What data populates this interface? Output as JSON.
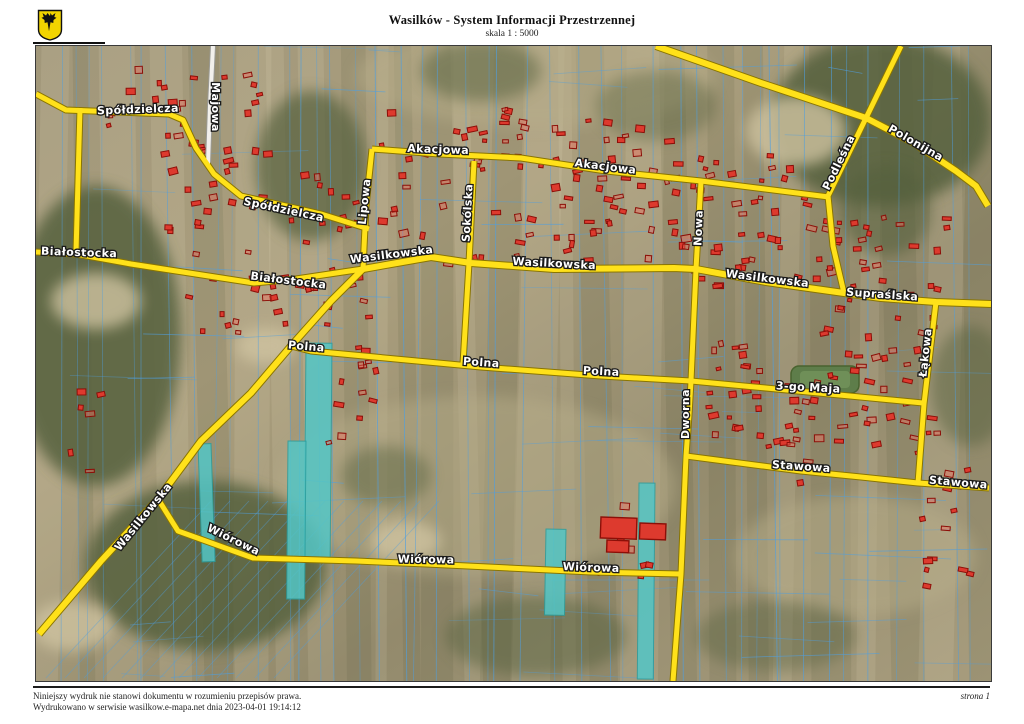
{
  "header": {
    "title": "Wasilków - System Informacji Przestrzennej",
    "scale_label": "skala 1 : 5000",
    "logo": "wasilkow-coat-of-arms-moose"
  },
  "footer": {
    "disclaimer": "Niniejszy wydruk nie stanowi dokumentu w rozumieniu przepisów prawa.",
    "printed_info": "Wydrukowano w serwisie wasilkow.e-mapa.net dnia 2023-04-01 19:14:12",
    "page_label": "strona 1"
  },
  "map": {
    "width": 955,
    "height": 635,
    "colors": {
      "road_fill": "#ffe11a",
      "road_casing": "#8a7500",
      "white_road": "#f2f0ec",
      "white_road_casing": "#9a9a94",
      "parcel_line": "#4f9fe0",
      "building_fill": "#dd3a2e",
      "building_fill_light": "rgba(240,110,95,0.45)",
      "building_stroke": "#8c0f08",
      "highlight_parcel": "#53c6c6",
      "highlight_stroke": "#2a9d9d",
      "label_fill": "#ffffff",
      "label_stroke": "#1a1a1a",
      "forest": "#55613c",
      "sand": "#cfc3a0",
      "field_light": "#b7ad89",
      "sports_green": "#5e7d4a"
    },
    "roads": [
      {
        "name": "majowa",
        "kind": "white",
        "w": 4,
        "points": [
          [
            177,
            0
          ],
          [
            174,
            60
          ],
          [
            172,
            118
          ]
        ]
      },
      {
        "name": "spoldzielcza",
        "kind": "yellow",
        "w": 5,
        "points": [
          [
            0,
            48
          ],
          [
            30,
            64
          ],
          [
            133,
            68
          ],
          [
            147,
            74
          ],
          [
            160,
            102
          ],
          [
            178,
            128
          ],
          [
            205,
            150
          ],
          [
            250,
            160
          ],
          [
            285,
            168
          ],
          [
            333,
            183
          ]
        ]
      },
      {
        "name": "bialostocka-north-leg",
        "kind": "yellow",
        "w": 5,
        "points": [
          [
            44,
            62
          ],
          [
            40,
            207
          ]
        ]
      },
      {
        "name": "bialostocka",
        "kind": "yellow",
        "w": 5,
        "points": [
          [
            0,
            206
          ],
          [
            40,
            208
          ],
          [
            95,
            218
          ],
          [
            218,
            237
          ],
          [
            260,
            233
          ],
          [
            327,
            223
          ]
        ]
      },
      {
        "name": "lipowa",
        "kind": "yellow",
        "w": 5,
        "points": [
          [
            336,
            103
          ],
          [
            330,
            160
          ],
          [
            327,
            223
          ]
        ]
      },
      {
        "name": "akacjowa",
        "kind": "yellow",
        "w": 5,
        "points": [
          [
            336,
            103
          ],
          [
            403,
            108
          ],
          [
            485,
            112
          ],
          [
            570,
            125
          ],
          [
            665,
            135
          ],
          [
            793,
            151
          ]
        ]
      },
      {
        "name": "nowa",
        "kind": "yellow",
        "w": 5,
        "points": [
          [
            665,
            135
          ],
          [
            660,
            223
          ]
        ]
      },
      {
        "name": "sokolska",
        "kind": "yellow",
        "w": 5,
        "points": [
          [
            438,
            115
          ],
          [
            433,
            217
          ],
          [
            427,
            318
          ]
        ]
      },
      {
        "name": "podlesna",
        "kind": "yellow",
        "w": 5,
        "points": [
          [
            865,
            0
          ],
          [
            830,
            72
          ],
          [
            792,
            150
          ],
          [
            797,
            200
          ],
          [
            808,
            247
          ]
        ]
      },
      {
        "name": "polonijna",
        "kind": "yellow",
        "w": 6,
        "points": [
          [
            620,
            0
          ],
          [
            725,
            37
          ],
          [
            830,
            72
          ],
          [
            878,
            97
          ],
          [
            920,
            125
          ],
          [
            940,
            140
          ],
          [
            952,
            160
          ]
        ]
      },
      {
        "name": "wasilkowska",
        "kind": "yellow",
        "w": 6,
        "points": [
          [
            327,
            223
          ],
          [
            395,
            211
          ],
          [
            435,
            217
          ],
          [
            518,
            223
          ],
          [
            638,
            222
          ],
          [
            660,
            223
          ],
          [
            730,
            236
          ],
          [
            808,
            247
          ],
          [
            845,
            252
          ],
          [
            900,
            256
          ],
          [
            955,
            258
          ]
        ]
      },
      {
        "name": "lakowa",
        "kind": "yellow",
        "w": 5,
        "points": [
          [
            900,
            256
          ],
          [
            888,
            358
          ],
          [
            882,
            437
          ]
        ]
      },
      {
        "name": "wasilkowska-sw",
        "kind": "yellow",
        "w": 6,
        "points": [
          [
            327,
            223
          ],
          [
            295,
            255
          ],
          [
            255,
            300
          ],
          [
            215,
            347
          ],
          [
            165,
            395
          ],
          [
            122,
            453
          ],
          [
            65,
            515
          ],
          [
            3,
            588
          ]
        ]
      },
      {
        "name": "polna",
        "kind": "yellow",
        "w": 5,
        "points": [
          [
            255,
            300
          ],
          [
            275,
            305
          ],
          [
            445,
            321
          ],
          [
            565,
            330
          ],
          [
            655,
            335
          ]
        ]
      },
      {
        "name": "trzeciego-maja",
        "kind": "yellow",
        "w": 5,
        "points": [
          [
            655,
            335
          ],
          [
            772,
            346
          ],
          [
            887,
            357
          ]
        ]
      },
      {
        "name": "dworna",
        "kind": "yellow",
        "w": 5,
        "points": [
          [
            660,
            223
          ],
          [
            655,
            335
          ],
          [
            653,
            369
          ],
          [
            650,
            410
          ],
          [
            645,
            528
          ],
          [
            637,
            635
          ]
        ]
      },
      {
        "name": "stawowa",
        "kind": "yellow",
        "w": 5,
        "points": [
          [
            650,
            410
          ],
          [
            765,
            425
          ],
          [
            825,
            431
          ],
          [
            882,
            437
          ],
          [
            953,
            442
          ]
        ]
      },
      {
        "name": "wiorowa",
        "kind": "yellow",
        "w": 5,
        "points": [
          [
            122,
            453
          ],
          [
            142,
            485
          ],
          [
            217,
            512
          ],
          [
            320,
            515
          ],
          [
            390,
            518
          ],
          [
            555,
            526
          ],
          [
            645,
            528
          ]
        ]
      }
    ],
    "street_labels": [
      {
        "text": "Spółdzielcza",
        "x": 102,
        "y": 67,
        "rot": -2
      },
      {
        "text": "Majowa",
        "x": 176,
        "y": 61,
        "rot": 90
      },
      {
        "text": "Spółdzielcza",
        "x": 247,
        "y": 167,
        "rot": 12
      },
      {
        "text": "Białostocka",
        "x": 43,
        "y": 210,
        "rot": 2
      },
      {
        "text": "Białostocka",
        "x": 252,
        "y": 238,
        "rot": 7
      },
      {
        "text": "Akacjowa",
        "x": 402,
        "y": 107,
        "rot": 2
      },
      {
        "text": "Akacjowa",
        "x": 569,
        "y": 124,
        "rot": 7
      },
      {
        "text": "Lipowa",
        "x": 332,
        "y": 156,
        "rot": -84
      },
      {
        "text": "Sokólska",
        "x": 435,
        "y": 167,
        "rot": -87
      },
      {
        "text": "Nowa",
        "x": 666,
        "y": 182,
        "rot": -88
      },
      {
        "text": "Wasilkowska",
        "x": 356,
        "y": 212,
        "rot": -7
      },
      {
        "text": "Wasilkowska",
        "x": 518,
        "y": 221,
        "rot": 3
      },
      {
        "text": "Wasilkowska",
        "x": 731,
        "y": 236,
        "rot": 7
      },
      {
        "text": "Supraślska",
        "x": 846,
        "y": 252,
        "rot": 4
      },
      {
        "text": "Podleśna",
        "x": 806,
        "y": 118,
        "rot": -64
      },
      {
        "text": "Polonijna",
        "x": 878,
        "y": 100,
        "rot": 30
      },
      {
        "text": "Polna",
        "x": 270,
        "y": 304,
        "rot": 5
      },
      {
        "text": "Polna",
        "x": 445,
        "y": 320,
        "rot": 4
      },
      {
        "text": "Polna",
        "x": 565,
        "y": 329,
        "rot": 3
      },
      {
        "text": "3-go Maja",
        "x": 772,
        "y": 345,
        "rot": 3
      },
      {
        "text": "Dworna",
        "x": 653,
        "y": 368,
        "rot": -90
      },
      {
        "text": "Łąkowa",
        "x": 893,
        "y": 307,
        "rot": -84
      },
      {
        "text": "Stawowa",
        "x": 765,
        "y": 424,
        "rot": 4
      },
      {
        "text": "Stawowa",
        "x": 922,
        "y": 440,
        "rot": 5
      },
      {
        "text": "Wasilkowska",
        "x": 110,
        "y": 473,
        "rot": -51
      },
      {
        "text": "Wiórowa",
        "x": 196,
        "y": 497,
        "rot": 26
      },
      {
        "text": "Wiórowa",
        "x": 390,
        "y": 517,
        "rot": 1
      },
      {
        "text": "Wiórowa",
        "x": 555,
        "y": 525,
        "rot": 2
      }
    ],
    "forests": [
      {
        "cx": 60,
        "cy": 290,
        "rx": 85,
        "ry": 150,
        "o": 0.85
      },
      {
        "cx": 170,
        "cy": 520,
        "rx": 120,
        "ry": 85,
        "o": 0.85
      },
      {
        "cx": 845,
        "cy": 75,
        "rx": 110,
        "ry": 85,
        "o": 0.85
      },
      {
        "cx": 275,
        "cy": 120,
        "rx": 55,
        "ry": 75,
        "o": 0.7
      },
      {
        "cx": 445,
        "cy": 25,
        "rx": 60,
        "ry": 30,
        "o": 0.5
      },
      {
        "cx": 620,
        "cy": 60,
        "rx": 60,
        "ry": 35,
        "o": 0.4
      },
      {
        "cx": 850,
        "cy": 165,
        "rx": 45,
        "ry": 45,
        "o": 0.6
      },
      {
        "cx": 350,
        "cy": 430,
        "rx": 45,
        "ry": 30,
        "o": 0.45
      },
      {
        "cx": 500,
        "cy": 590,
        "rx": 90,
        "ry": 40,
        "o": 0.5
      },
      {
        "cx": 740,
        "cy": 590,
        "rx": 80,
        "ry": 35,
        "o": 0.4
      },
      {
        "cx": 935,
        "cy": 340,
        "rx": 40,
        "ry": 60,
        "o": 0.5
      }
    ],
    "sands": [
      {
        "cx": 760,
        "cy": 85,
        "rx": 50,
        "ry": 35
      },
      {
        "cx": 60,
        "cy": 255,
        "rx": 45,
        "ry": 28
      },
      {
        "cx": 370,
        "cy": 495,
        "rx": 35,
        "ry": 20
      },
      {
        "cx": 230,
        "cy": 300,
        "rx": 30,
        "ry": 18
      },
      {
        "cx": 35,
        "cy": 580,
        "rx": 40,
        "ry": 25
      }
    ],
    "light_fields": [
      {
        "cx": 440,
        "cy": 440,
        "rx": 200,
        "ry": 90
      },
      {
        "cx": 500,
        "cy": 30,
        "rx": 180,
        "ry": 50
      },
      {
        "cx": 820,
        "cy": 510,
        "rx": 120,
        "ry": 60
      }
    ],
    "highlight_parcels": [
      {
        "x": 270,
        "y": 297,
        "w": 26,
        "h": 216,
        "rot": 0.5
      },
      {
        "x": 252,
        "y": 395,
        "w": 18,
        "h": 158,
        "rot": 0.5
      },
      {
        "x": 510,
        "y": 483,
        "w": 20,
        "h": 86,
        "rot": 1
      },
      {
        "x": 603,
        "y": 437,
        "w": 16,
        "h": 196,
        "rot": 0.5
      },
      {
        "x": 162,
        "y": 398,
        "w": 13,
        "h": 118,
        "rot": -2
      }
    ],
    "building_clusters": [
      {
        "x": 110,
        "y": 10,
        "w": 120,
        "h": 230,
        "n": 45
      },
      {
        "x": 250,
        "y": 120,
        "w": 80,
        "h": 120,
        "n": 18
      },
      {
        "x": 340,
        "y": 60,
        "w": 150,
        "h": 160,
        "n": 45
      },
      {
        "x": 490,
        "y": 70,
        "w": 160,
        "h": 150,
        "n": 55
      },
      {
        "x": 650,
        "y": 100,
        "w": 130,
        "h": 140,
        "n": 40
      },
      {
        "x": 780,
        "y": 170,
        "w": 130,
        "h": 120,
        "n": 40
      },
      {
        "x": 150,
        "y": 230,
        "w": 170,
        "h": 60,
        "n": 18
      },
      {
        "x": 280,
        "y": 250,
        "w": 60,
        "h": 150,
        "n": 16
      },
      {
        "x": 660,
        "y": 290,
        "w": 120,
        "h": 110,
        "n": 30
      },
      {
        "x": 790,
        "y": 300,
        "w": 120,
        "h": 110,
        "n": 30
      },
      {
        "x": 880,
        "y": 420,
        "w": 60,
        "h": 120,
        "n": 14
      },
      {
        "x": 20,
        "y": 330,
        "w": 60,
        "h": 100,
        "n": 6
      },
      {
        "x": 540,
        "y": 450,
        "w": 90,
        "h": 80,
        "n": 8
      },
      {
        "x": 60,
        "y": 20,
        "w": 60,
        "h": 60,
        "n": 5
      },
      {
        "x": 700,
        "y": 380,
        "w": 80,
        "h": 60,
        "n": 10
      }
    ],
    "landmarks": {
      "school_buildings": [
        {
          "x": 565,
          "y": 471,
          "w": 36,
          "h": 21,
          "rot": 2
        },
        {
          "x": 604,
          "y": 477,
          "w": 26,
          "h": 16,
          "rot": 2
        },
        {
          "x": 571,
          "y": 494,
          "w": 22,
          "h": 12,
          "rot": 2
        }
      ],
      "sports_field": {
        "x": 755,
        "y": 320,
        "w": 68,
        "h": 27
      }
    }
  }
}
